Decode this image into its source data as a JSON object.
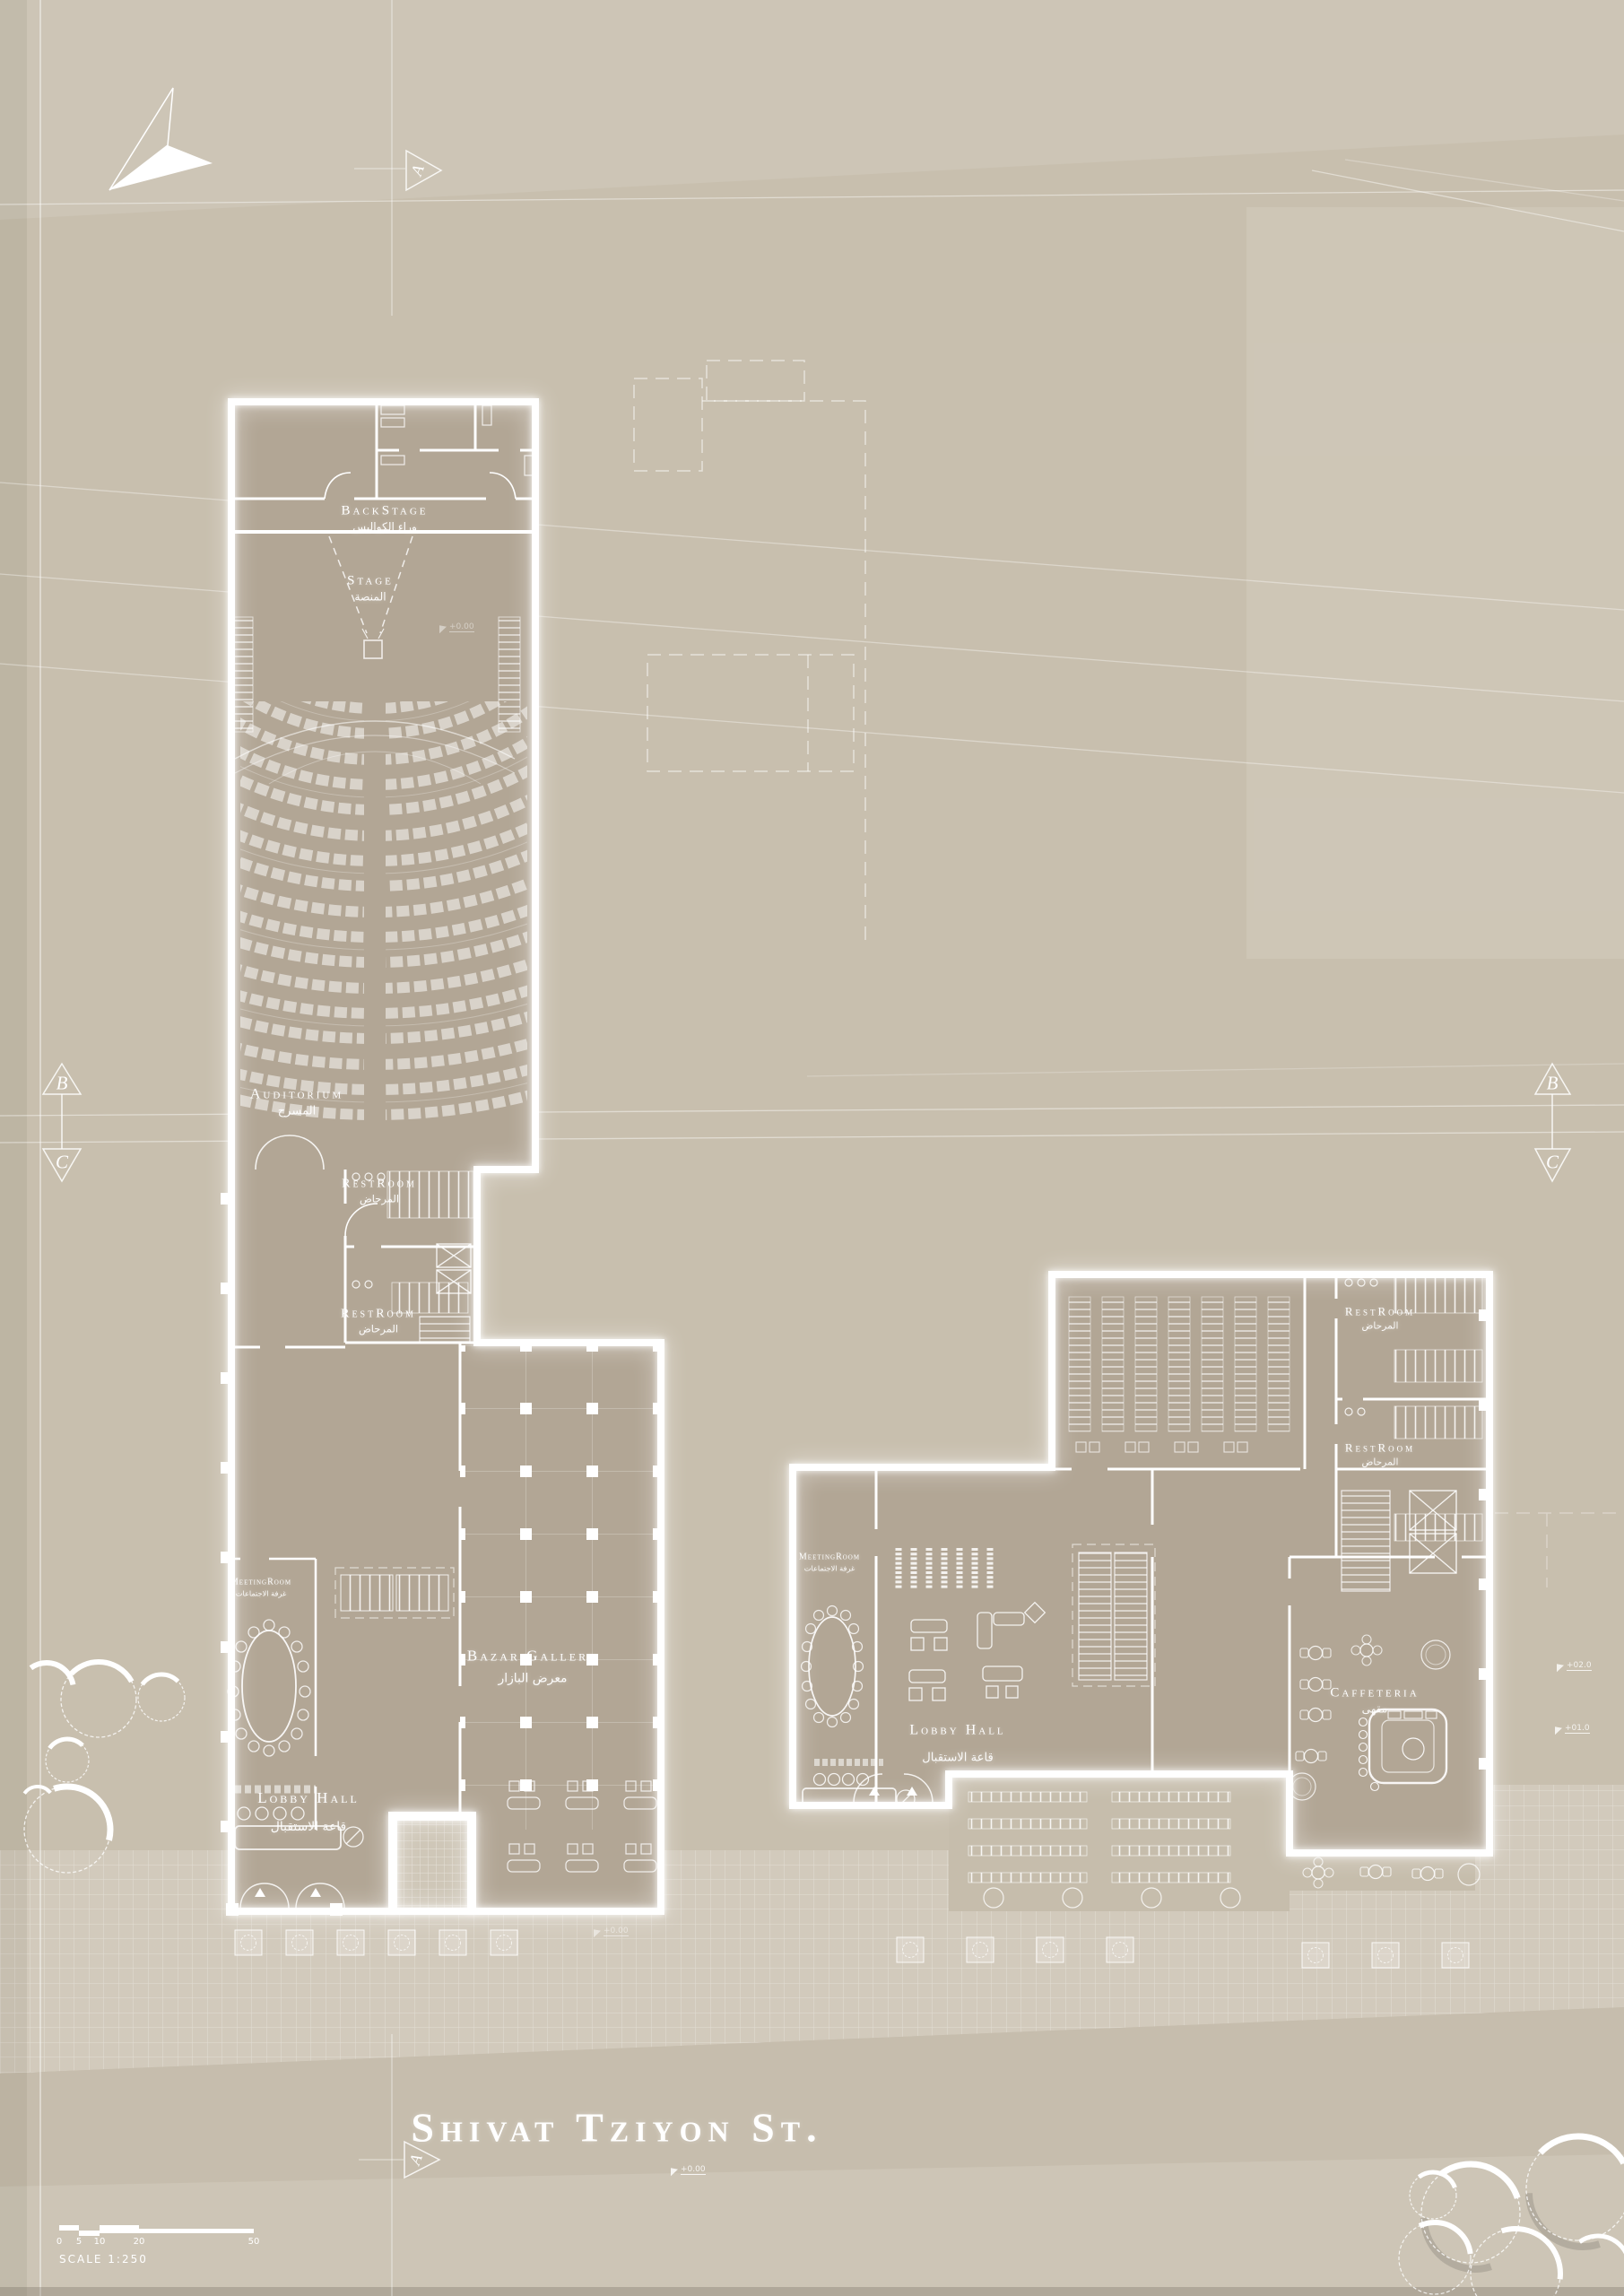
{
  "street": {
    "name": "Shivat Tziyon St."
  },
  "rooms": {
    "backstage": {
      "en": "BackStage",
      "ar": "وراء الكواليس"
    },
    "stage": {
      "en": "Stage",
      "ar": "المنصة"
    },
    "auditorium": {
      "en": "Auditorium",
      "ar": "المسرح"
    },
    "restroom": {
      "en": "RestRoom",
      "ar": "المرحاض"
    },
    "meeting_room": {
      "en": "MeetingRoom",
      "ar": "غرفة الاجتماعات"
    },
    "bazar_gallery": {
      "en": "Bazar Gallery",
      "ar": "معرض البازار"
    },
    "lobby_hall": {
      "en": "Lobby Hall",
      "ar": "قاعة الاستقبال"
    },
    "caffeteria": {
      "en": "Caffeteria",
      "ar": "مقهى"
    }
  },
  "section_markers": {
    "a": "A",
    "b": "B",
    "c": "C"
  },
  "elevations": {
    "ground": "+0.00",
    "first": "+01.0",
    "second": "+02.0"
  },
  "scale_bar": {
    "label": "SCALE  1:250",
    "ticks": [
      "0",
      "5",
      "10",
      "20",
      "50"
    ]
  },
  "colors": {
    "sheet": "#c8bfae",
    "floor": "#b2a695",
    "wall": "#ffffff",
    "plaza": "#d2cabc",
    "street_surface": "#c6bdad",
    "sidewalk": "#cdc5b6"
  }
}
